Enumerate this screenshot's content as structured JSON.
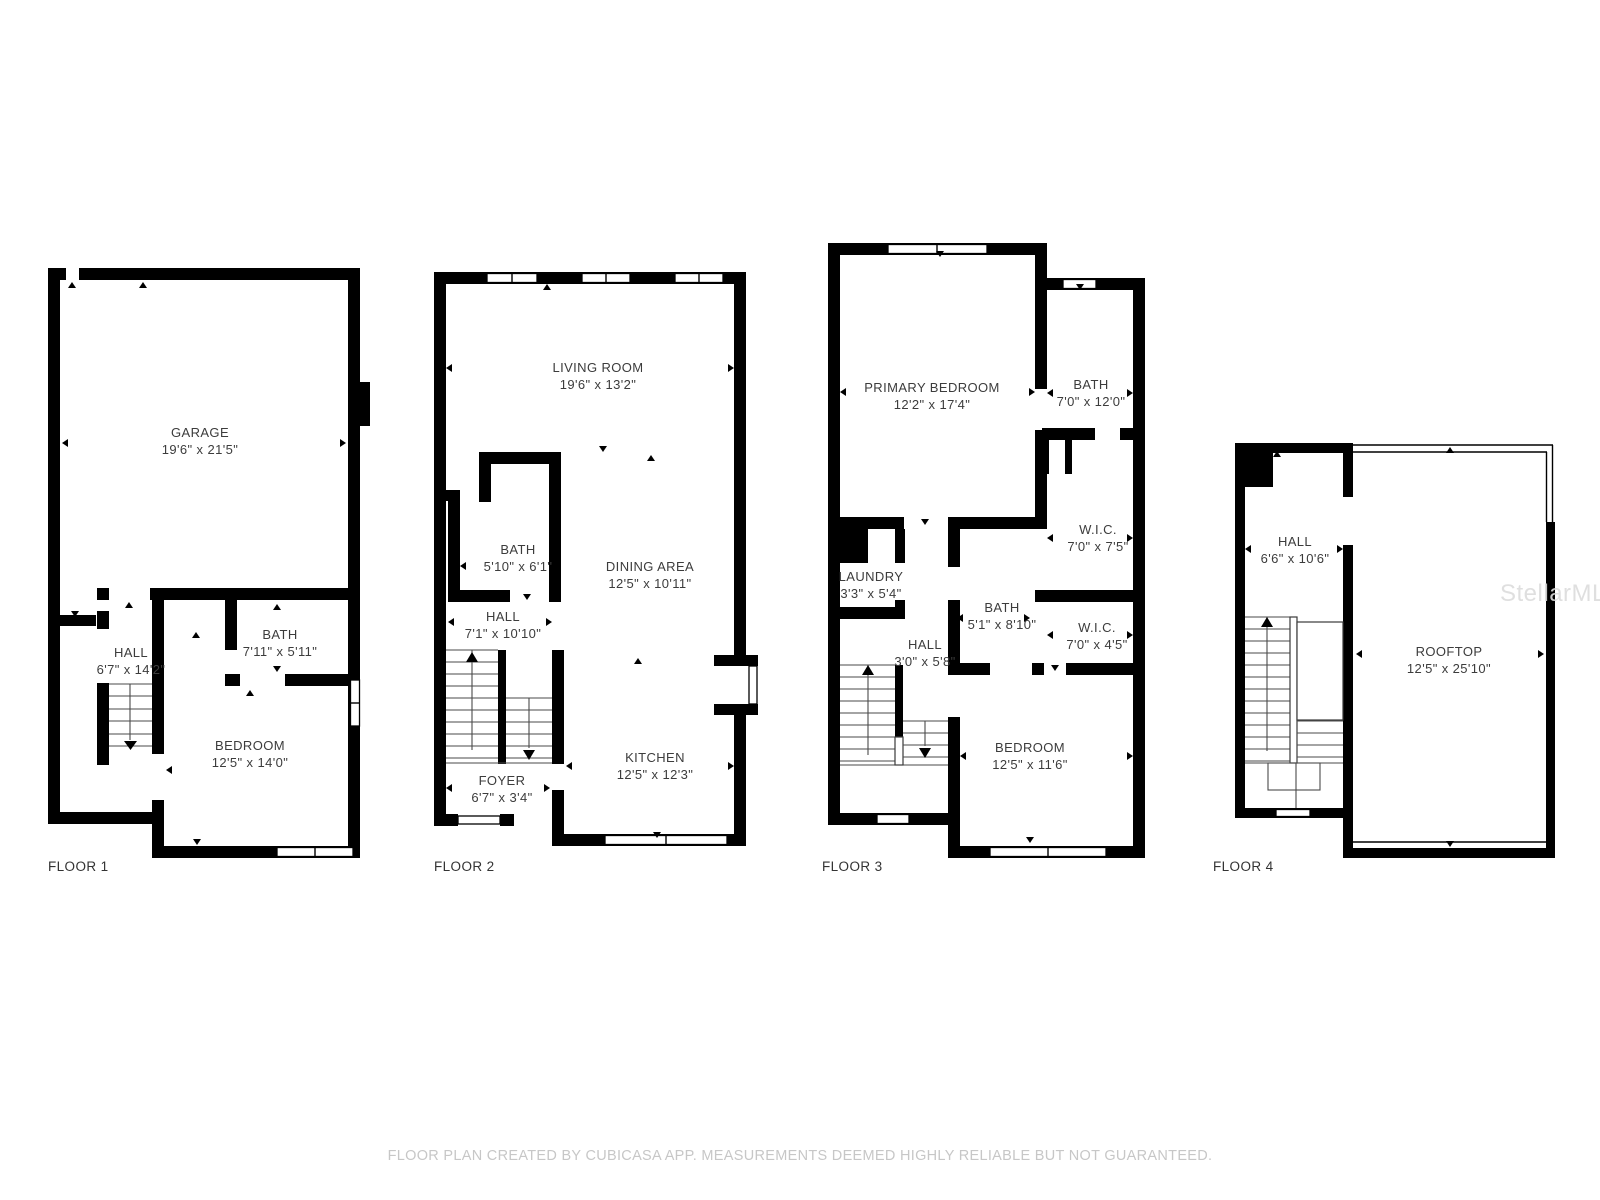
{
  "floors": [
    {
      "label": "FLOOR 1",
      "rooms": [
        {
          "name": "GARAGE",
          "dims": "19'6\" x 21'5\""
        },
        {
          "name": "HALL",
          "dims": "6'7\" x 14'2\""
        },
        {
          "name": "BATH",
          "dims": "7'11\" x 5'11\""
        },
        {
          "name": "BEDROOM",
          "dims": "12'5\" x 14'0\""
        }
      ]
    },
    {
      "label": "FLOOR 2",
      "rooms": [
        {
          "name": "LIVING ROOM",
          "dims": "19'6\" x 13'2\""
        },
        {
          "name": "BATH",
          "dims": "5'10\" x 6'1\""
        },
        {
          "name": "DINING AREA",
          "dims": "12'5\" x 10'11\""
        },
        {
          "name": "HALL",
          "dims": "7'1\" x 10'10\""
        },
        {
          "name": "FOYER",
          "dims": "6'7\" x 3'4\""
        },
        {
          "name": "KITCHEN",
          "dims": "12'5\" x 12'3\""
        }
      ]
    },
    {
      "label": "FLOOR 3",
      "rooms": [
        {
          "name": "PRIMARY BEDROOM",
          "dims": "12'2\" x 17'4\""
        },
        {
          "name": "BATH",
          "dims": "7'0\" x 12'0\""
        },
        {
          "name": "W.I.C.",
          "dims": "7'0\" x 7'5\""
        },
        {
          "name": "LAUNDRY",
          "dims": "3'3\" x 5'4\""
        },
        {
          "name": "BATH",
          "dims": "5'1\" x 8'10\""
        },
        {
          "name": "HALL",
          "dims": "3'0\" x 5'8\""
        },
        {
          "name": "W.I.C.",
          "dims": "7'0\" x 4'5\""
        },
        {
          "name": "BEDROOM",
          "dims": "12'5\" x 11'6\""
        }
      ]
    },
    {
      "label": "FLOOR 4",
      "rooms": [
        {
          "name": "HALL",
          "dims": "6'6\" x 10'6\""
        },
        {
          "name": "ROOFTOP",
          "dims": "12'5\" x 25'10\""
        }
      ]
    }
  ],
  "footer": {
    "disclaimer": "FLOOR PLAN CREATED BY CUBICASA APP. MEASUREMENTS DEEMED HIGHLY RELIABLE BUT NOT GUARANTEED."
  },
  "watermark": "StellarMLS",
  "colors": {
    "wall": "#000000",
    "background": "#ffffff",
    "label": "#3c3c3c",
    "muted": "#c7c7c7"
  }
}
